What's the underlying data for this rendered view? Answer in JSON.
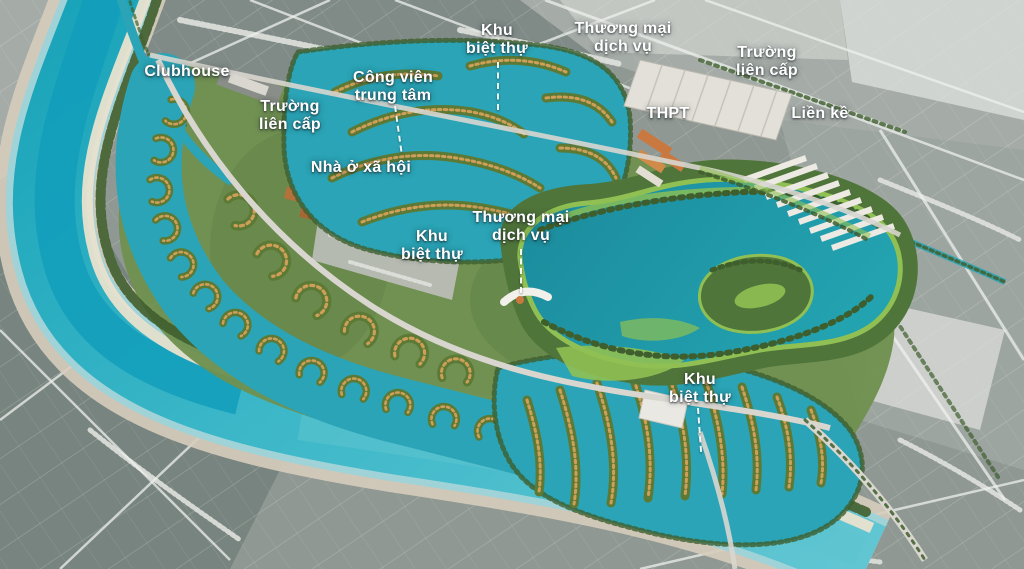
{
  "colors": {
    "label_text": "#ffffff",
    "leader_line": "#ffffff",
    "river_water": "#3bb7c8",
    "river_deep": "#129dbb",
    "river_pale": "#9fd3d8",
    "shore_sand": "#d6cdbc",
    "beach": "#e9e1cd",
    "lagoon": "#2aa4b6",
    "lake": "#1f98a8",
    "lake_deep": "#1b8b9c",
    "lawn": "#90c053",
    "park_green": "#50753a",
    "site_green": "#6f9150",
    "tree_dark": "#3f5e2d",
    "villa_green": "#5c7a36",
    "roof_tan": "#cf9f58",
    "building_orange": "#c9793f",
    "roof_white": "#eceae3",
    "land_base": "#8f9893",
    "land_light": "#aab1ac",
    "land_dark": "#75827d",
    "village_white": "#dfe1dd",
    "road_site": "#d8d6cf",
    "boat_white": "#fdfdfc"
  },
  "map": {
    "labels": [
      {
        "id": "clubhouse",
        "lines": [
          "Clubhouse"
        ],
        "x": 187,
        "y": 72
      },
      {
        "id": "truong-lien-cap-west",
        "lines": [
          "Trường",
          "liên cấp"
        ],
        "x": 290,
        "y": 116
      },
      {
        "id": "cong-vien-trung-tam",
        "lines": [
          "Công viên",
          "trung tâm"
        ],
        "x": 393,
        "y": 87,
        "leader": {
          "x": 394,
          "y": 106,
          "len": 46,
          "angle": -8
        }
      },
      {
        "id": "khu-biet-thu-north",
        "lines": [
          "Khu",
          "biệt thự"
        ],
        "x": 497,
        "y": 40,
        "leader": {
          "x": 497,
          "y": 62,
          "len": 48,
          "angle": 0
        }
      },
      {
        "id": "thuong-mai-dich-vu-north",
        "lines": [
          "Thương mại",
          "dịch vụ"
        ],
        "x": 623,
        "y": 38
      },
      {
        "id": "truong-lien-cap-east",
        "lines": [
          "Trường",
          "liên cấp"
        ],
        "x": 767,
        "y": 62
      },
      {
        "id": "thpt",
        "lines": [
          "THPT"
        ],
        "x": 668,
        "y": 114
      },
      {
        "id": "lien-ke",
        "lines": [
          "Liền kề"
        ],
        "x": 820,
        "y": 114
      },
      {
        "id": "nha-o-xa-hoi",
        "lines": [
          "Nhà ở xã hội"
        ],
        "x": 361,
        "y": 168
      },
      {
        "id": "khu-biet-thu-west",
        "lines": [
          "Khu",
          "biệt thự"
        ],
        "x": 432,
        "y": 246
      },
      {
        "id": "thuong-mai-dich-vu-central",
        "lines": [
          "Thương mại",
          "dịch vụ"
        ],
        "x": 521,
        "y": 227,
        "leader": {
          "x": 520,
          "y": 249,
          "len": 44,
          "angle": 0
        }
      },
      {
        "id": "khu-biet-thu-south",
        "lines": [
          "Khu",
          "biệt thự"
        ],
        "x": 700,
        "y": 389,
        "leader": {
          "x": 697,
          "y": 408,
          "len": 44,
          "angle": -4
        }
      }
    ]
  }
}
